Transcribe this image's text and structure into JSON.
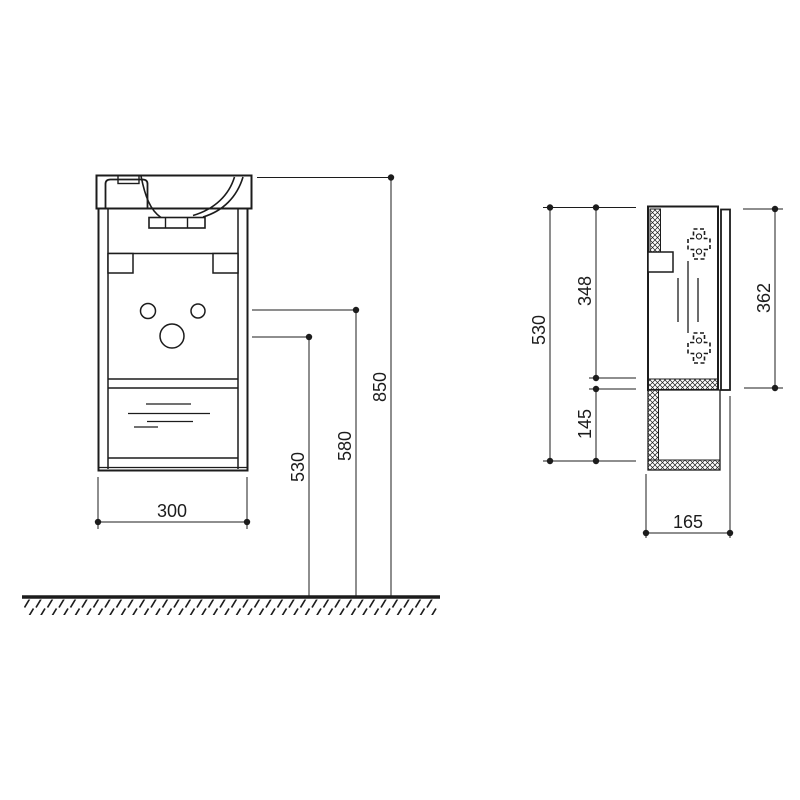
{
  "colors": {
    "line": "#1c1c1c",
    "background": "#ffffff"
  },
  "front_view": {
    "dimensions": {
      "width": {
        "value": "300"
      },
      "height_530": {
        "value": "530"
      },
      "height_580": {
        "value": "580"
      },
      "height_850": {
        "value": "850"
      }
    }
  },
  "side_view": {
    "dimensions": {
      "height_530": {
        "value": "530"
      },
      "height_348": {
        "value": "348"
      },
      "height_145": {
        "value": "145"
      },
      "height_362": {
        "value": "362"
      },
      "depth_165": {
        "value": "165"
      }
    }
  }
}
